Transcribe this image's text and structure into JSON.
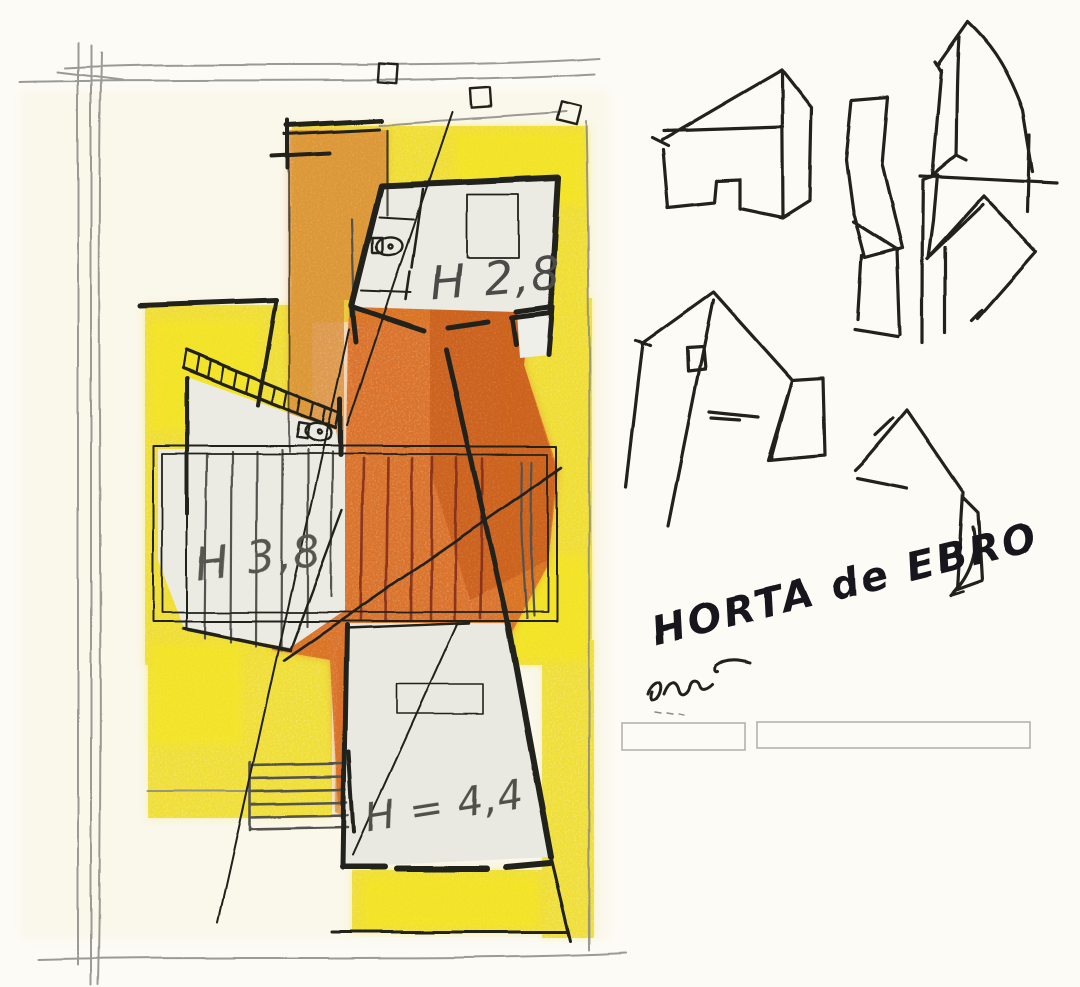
{
  "artwork": {
    "kind": "hand-drawn architectural concept sketch",
    "annotations": {
      "level_upper": "H 2,8",
      "level_middle": "H 3,8",
      "level_lower": "H = 4,4",
      "place_title": "HORTA de EBRO",
      "scribble": "cem"
    },
    "footer_boxes": [
      "",
      ""
    ],
    "icons": [
      {
        "name": "toilet-icon",
        "shape": "ellipse bowl + cistern rect"
      },
      {
        "name": "stair-ladder-icon",
        "shape": "double rail with rungs"
      },
      {
        "name": "survey-marker-icon",
        "shape": "small tilted square"
      },
      {
        "name": "arrow-icon",
        "shape": "curved stroke with arrowhead"
      }
    ],
    "colors": {
      "paper": "#fcfbf6",
      "yellow": "#f3e63a",
      "yellow_bright": "#f6e81f",
      "yellow_soft": "#f6efae",
      "orange": "#dd7c34",
      "orange_deep": "#d96f28",
      "ink": "#21201c",
      "pencil": "#8b8a86",
      "riser_red": "#7e2c1a",
      "room_fill": "#ebebe4",
      "box_stroke": "#b4b3ae"
    }
  }
}
